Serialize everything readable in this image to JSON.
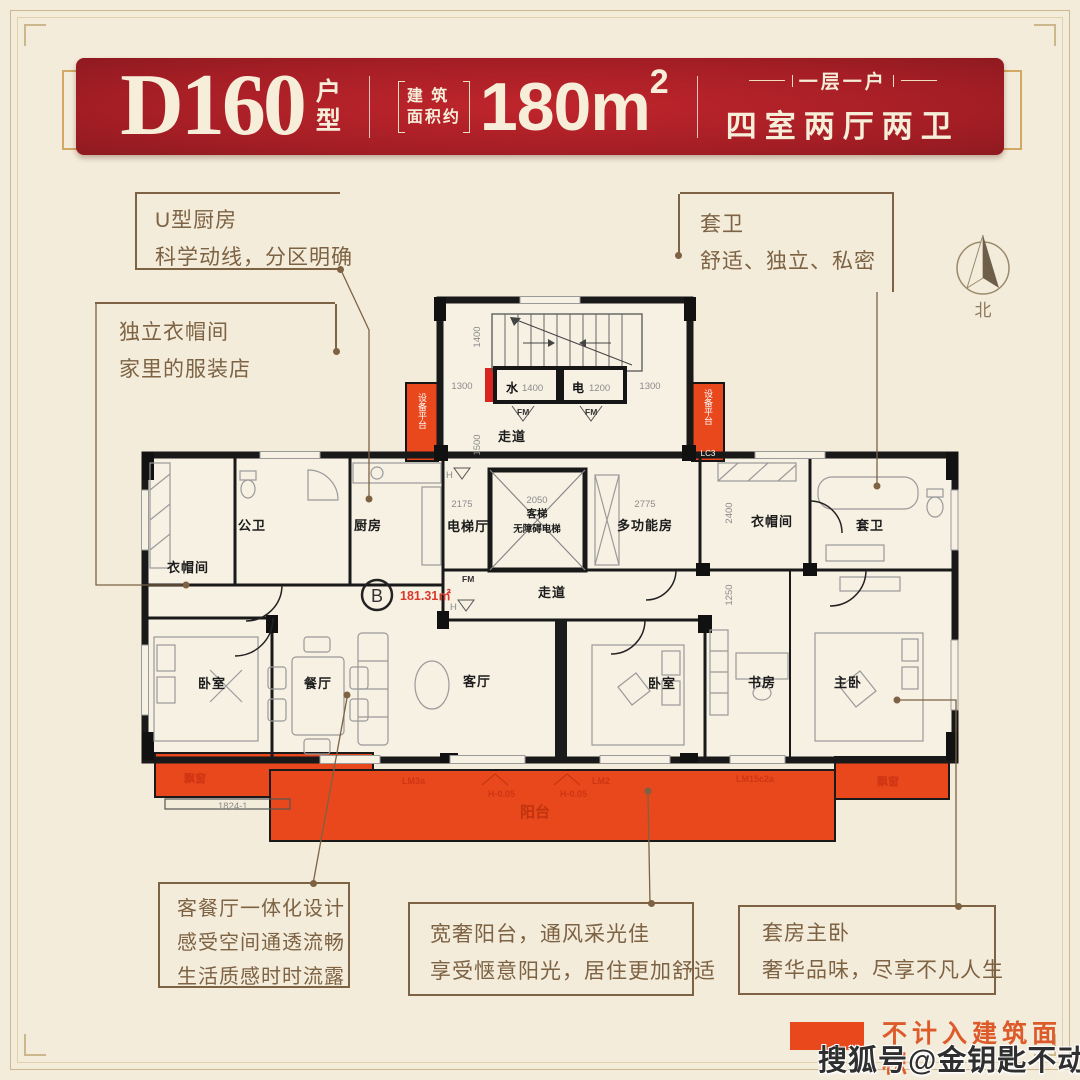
{
  "colors": {
    "banner_red": "#A51E25",
    "accent_orange": "#E8481C",
    "callout_brown": "#7D6243",
    "plan_red": "#D6392B",
    "legend_text": "#DD5A2A",
    "background": "#F4ECDB"
  },
  "header": {
    "model": "D160",
    "model_suffix_1": "户",
    "model_suffix_2": "型",
    "area_prefix_line1": "建 筑",
    "area_prefix_line2": "面积约",
    "area_value": "180m",
    "area_sup": "2",
    "tagline_top": "一层一户",
    "tagline_bottom": "四室两厅两卫"
  },
  "callouts": {
    "kitchen": {
      "lines": [
        "U型厨房",
        "科学动线，分区明确"
      ]
    },
    "ensuite": {
      "lines": [
        "套卫",
        "舒适、独立、私密"
      ]
    },
    "wardrobe": {
      "lines": [
        "独立衣帽间",
        "家里的服装店"
      ]
    },
    "living": {
      "lines": [
        "客餐厅一体化设计",
        "感受空间通透流畅",
        "生活质感时时流露"
      ]
    },
    "balcony": {
      "lines": [
        "宽奢阳台，通风采光佳",
        "享受惬意阳光，居住更加舒适"
      ]
    },
    "master": {
      "lines": [
        "套房主卧",
        "奢华品味，尽享不凡人生"
      ]
    }
  },
  "compass": {
    "label": "北"
  },
  "plan": {
    "unit_mark": "B",
    "area_text": "181.31㎡",
    "rooms": {
      "wardrobe_left": "衣帽间",
      "bath_public": "公卫",
      "kitchen": "厨房",
      "elevator_hall": "电梯厅",
      "elevator_line1": "客梯",
      "elevator_line2": "无障碍电梯",
      "multi_room": "多功能房",
      "wardrobe_right": "衣帽间",
      "bath_ensuite": "套卫",
      "corridor_top": "走道",
      "corridor": "走道",
      "bedroom_left": "卧室",
      "dining": "餐厅",
      "living": "客厅",
      "bedroom_mid": "卧室",
      "study": "书房",
      "master": "主卧",
      "balcony": "阳台",
      "bay_left": "飘窗",
      "bay_right": "飘窗",
      "shaft_water": "水",
      "shaft_elec": "电",
      "equip_left": "设备平台",
      "equip_right": "设备平台"
    },
    "dims": {
      "w1400": "1400",
      "e1200": "1200",
      "d1400": "1400",
      "d1500": "1500",
      "d1300a": "1300",
      "d1300b": "1300",
      "d2175": "2175",
      "d2050": "2050",
      "d2775": "2775",
      "d2400": "2400",
      "d1250": "1250",
      "d1824": "1824-1"
    },
    "marks": {
      "fm1": "FM",
      "fm2": "FM",
      "fm3": "FM",
      "h1": "H",
      "h2": "H",
      "lc3": "LC3",
      "lm3a": "LM3a",
      "lm2": "LM2",
      "lm15": "LM15c2a",
      "hd1": "H-0.05",
      "hd2": "H-0.05"
    }
  },
  "legend": {
    "label": "不计入建筑面积"
  },
  "watermark": {
    "text": "搜狐号@金钥匙不动产"
  }
}
